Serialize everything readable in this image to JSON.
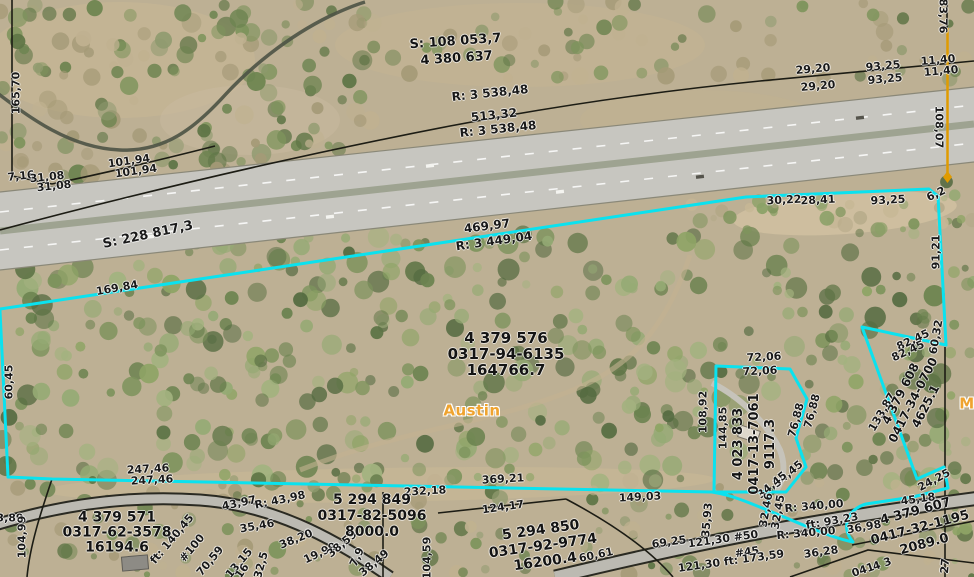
{
  "map": {
    "colors": {
      "highlight": "#0ae2ef",
      "boundary": "#1c1c14",
      "label_text": "#191919",
      "place_text": "#efa32e",
      "survey_line": "#e09b00"
    },
    "place_labels": [
      {
        "t": "Austin",
        "x": 472,
        "y": 411,
        "s": 15
      },
      {
        "t": "M",
        "x": 967,
        "y": 404,
        "s": 15
      }
    ],
    "parcels": [
      {
        "lines": [
          "S: 108 053,7",
          "4 380 637"
        ],
        "x": 456,
        "y": 50,
        "r": -4,
        "s": 13,
        "lh": 17
      },
      {
        "lines": [
          "4 379 576",
          "0317-94-6135",
          "164766.7"
        ],
        "x": 506,
        "y": 354,
        "r": 0,
        "s": 15,
        "lh": 16
      },
      {
        "lines": [
          "4 379 571",
          "0317-62-3578",
          "16194.6"
        ],
        "x": 117,
        "y": 533,
        "r": 0,
        "s": 14,
        "lh": 15
      },
      {
        "lines": [
          "5 294 849",
          "0317-82-5096",
          "8000.0"
        ],
        "x": 372,
        "y": 516,
        "r": 0,
        "s": 14,
        "lh": 16
      },
      {
        "lines": [
          "5 294 850",
          "0317-92-9774",
          "16200.4"
        ],
        "x": 543,
        "y": 546,
        "r": -8,
        "s": 14,
        "lh": 16
      },
      {
        "lines": [
          "4 379 607",
          "0417-32-1195",
          "2089.0"
        ],
        "x": 920,
        "y": 528,
        "r": -15,
        "s": 13,
        "lh": 17
      },
      {
        "lines": [
          "4 379 608",
          "0417-34-0700",
          "4625.1"
        ],
        "x": 913,
        "y": 400,
        "r": -63,
        "s": 12,
        "lh": 14
      },
      {
        "lines": [
          "4 023 833",
          "0417-13-7061",
          "9117.3"
        ],
        "x": 755,
        "y": 444,
        "r": -90,
        "s": 13,
        "lh": 16
      }
    ],
    "dim_labels": [
      {
        "t": "R: 3 538,48",
        "x": 490,
        "y": 93,
        "r": -6,
        "s": 12
      },
      {
        "t": "513,32",
        "x": 494,
        "y": 115,
        "r": -6,
        "s": 12
      },
      {
        "t": "R: 3 538,48",
        "x": 498,
        "y": 129,
        "r": -6,
        "s": 12
      },
      {
        "t": "29,20",
        "x": 813,
        "y": 69,
        "r": -5
      },
      {
        "t": "29,20",
        "x": 818,
        "y": 86,
        "r": -5
      },
      {
        "t": "93,25",
        "x": 883,
        "y": 66,
        "r": -5
      },
      {
        "t": "93,25",
        "x": 885,
        "y": 79,
        "r": -5
      },
      {
        "t": "11,40",
        "x": 938,
        "y": 60,
        "r": -5
      },
      {
        "t": "11,40",
        "x": 941,
        "y": 71,
        "r": -5
      },
      {
        "t": "83,76",
        "x": 943,
        "y": 16,
        "r": 90
      },
      {
        "t": "108,07",
        "x": 939,
        "y": 127,
        "r": 90
      },
      {
        "t": "165,70",
        "x": 16,
        "y": 93,
        "r": -90
      },
      {
        "t": "101,94",
        "x": 129,
        "y": 161,
        "r": -8
      },
      {
        "t": "101,94",
        "x": 136,
        "y": 171,
        "r": -8
      },
      {
        "t": "7,16",
        "x": 21,
        "y": 176,
        "r": -6
      },
      {
        "t": "31,08",
        "x": 47,
        "y": 177,
        "r": -6
      },
      {
        "t": "31,08",
        "x": 54,
        "y": 186,
        "r": -6
      },
      {
        "t": "S: 228 817,3",
        "x": 148,
        "y": 235,
        "r": -12,
        "s": 13
      },
      {
        "t": "469,97",
        "x": 487,
        "y": 226,
        "r": -7,
        "s": 12
      },
      {
        "t": "R: 3 449,04",
        "x": 494,
        "y": 241,
        "r": -8,
        "s": 12
      },
      {
        "t": "169,84",
        "x": 117,
        "y": 288,
        "r": -10
      },
      {
        "t": "60,45",
        "x": 9,
        "y": 382,
        "r": -90
      },
      {
        "t": "30,22",
        "x": 784,
        "y": 200,
        "r": -3
      },
      {
        "t": "28,41",
        "x": 818,
        "y": 200,
        "r": -3
      },
      {
        "t": "93,25",
        "x": 888,
        "y": 200,
        "r": -3
      },
      {
        "t": "6,2",
        "x": 936,
        "y": 194,
        "r": -25
      },
      {
        "t": "91,21",
        "x": 936,
        "y": 252,
        "r": -90
      },
      {
        "t": "60,32",
        "x": 936,
        "y": 337,
        "r": -80
      },
      {
        "t": "82,45",
        "x": 913,
        "y": 340,
        "r": -25
      },
      {
        "t": "82,45",
        "x": 908,
        "y": 351,
        "r": -25
      },
      {
        "t": "133,87",
        "x": 882,
        "y": 412,
        "r": -60
      },
      {
        "t": "72,06",
        "x": 764,
        "y": 357,
        "r": -3
      },
      {
        "t": "72,06",
        "x": 760,
        "y": 371,
        "r": -3
      },
      {
        "t": "108,92",
        "x": 703,
        "y": 412,
        "r": -90
      },
      {
        "t": "144,85",
        "x": 723,
        "y": 428,
        "r": -90
      },
      {
        "t": "76,88",
        "x": 796,
        "y": 420,
        "r": -75
      },
      {
        "t": "76,88",
        "x": 812,
        "y": 411,
        "r": -75
      },
      {
        "t": "34,45",
        "x": 788,
        "y": 474,
        "r": -40
      },
      {
        "t": "34,45",
        "x": 772,
        "y": 485,
        "r": -40
      },
      {
        "t": "32,46",
        "x": 766,
        "y": 510,
        "r": -80
      },
      {
        "t": "32,45",
        "x": 778,
        "y": 512,
        "r": -80
      },
      {
        "t": "35,93",
        "x": 707,
        "y": 520,
        "r": -85
      },
      {
        "t": "R: 340,00",
        "x": 814,
        "y": 506,
        "r": -5
      },
      {
        "t": "ft: 93,23",
        "x": 832,
        "y": 521,
        "r": -10
      },
      {
        "t": "36,98",
        "x": 864,
        "y": 527,
        "r": -10
      },
      {
        "t": "R: 340,00",
        "x": 806,
        "y": 533,
        "r": -5
      },
      {
        "t": "36,28",
        "x": 821,
        "y": 552,
        "r": -8
      },
      {
        "t": "24,25",
        "x": 934,
        "y": 480,
        "r": -28
      },
      {
        "t": "45,18",
        "x": 918,
        "y": 499,
        "r": -8
      },
      {
        "t": "121,30 #50",
        "x": 723,
        "y": 539,
        "r": -8
      },
      {
        "t": "69,25",
        "x": 669,
        "y": 542,
        "r": -8
      },
      {
        "t": "#45",
        "x": 747,
        "y": 552,
        "r": -8
      },
      {
        "t": "121,30 ft: 173,59",
        "x": 731,
        "y": 561,
        "r": -8
      },
      {
        "t": "149,03",
        "x": 640,
        "y": 497,
        "r": -3
      },
      {
        "t": "369,21",
        "x": 503,
        "y": 479,
        "r": -3
      },
      {
        "t": "232,18",
        "x": 425,
        "y": 491,
        "r": -3
      },
      {
        "t": "124,17",
        "x": 503,
        "y": 507,
        "r": -8
      },
      {
        "t": "60,61",
        "x": 596,
        "y": 555,
        "r": -12
      },
      {
        "t": "104,59",
        "x": 427,
        "y": 558,
        "r": -90
      },
      {
        "t": "247,46",
        "x": 148,
        "y": 469,
        "r": -3
      },
      {
        "t": "247,46",
        "x": 152,
        "y": 480,
        "r": -3
      },
      {
        "t": "3,89",
        "x": 10,
        "y": 518,
        "r": 0
      },
      {
        "t": "104,99",
        "x": 22,
        "y": 537,
        "r": -90
      },
      {
        "t": "43,97",
        "x": 239,
        "y": 503,
        "r": -12
      },
      {
        "t": "R: 43,98",
        "x": 280,
        "y": 500,
        "r": -12
      },
      {
        "t": "35,46",
        "x": 257,
        "y": 526,
        "r": -10
      },
      {
        "t": "38,20",
        "x": 296,
        "y": 539,
        "r": -22
      },
      {
        "t": "19,99",
        "x": 320,
        "y": 553,
        "r": -25
      },
      {
        "t": "38,59",
        "x": 342,
        "y": 544,
        "r": -40
      },
      {
        "t": "7,9",
        "x": 357,
        "y": 557,
        "r": -65
      },
      {
        "t": "38,49",
        "x": 374,
        "y": 563,
        "r": -40
      },
      {
        "t": "ft: 140,45",
        "x": 172,
        "y": 539,
        "r": -50
      },
      {
        "t": "#100",
        "x": 192,
        "y": 548,
        "r": -50
      },
      {
        "t": "70,59",
        "x": 210,
        "y": 561,
        "r": -50
      },
      {
        "t": "13,15",
        "x": 239,
        "y": 563,
        "r": -50
      },
      {
        "t": "16",
        "x": 242,
        "y": 571,
        "r": -55
      },
      {
        "t": "32,5",
        "x": 261,
        "y": 565,
        "r": -75
      },
      {
        "t": "27",
        "x": 945,
        "y": 566,
        "r": -85
      },
      {
        "t": "4 3",
        "x": 882,
        "y": 564,
        "r": -19
      },
      {
        "t": "041",
        "x": 863,
        "y": 570,
        "r": -19
      }
    ]
  }
}
